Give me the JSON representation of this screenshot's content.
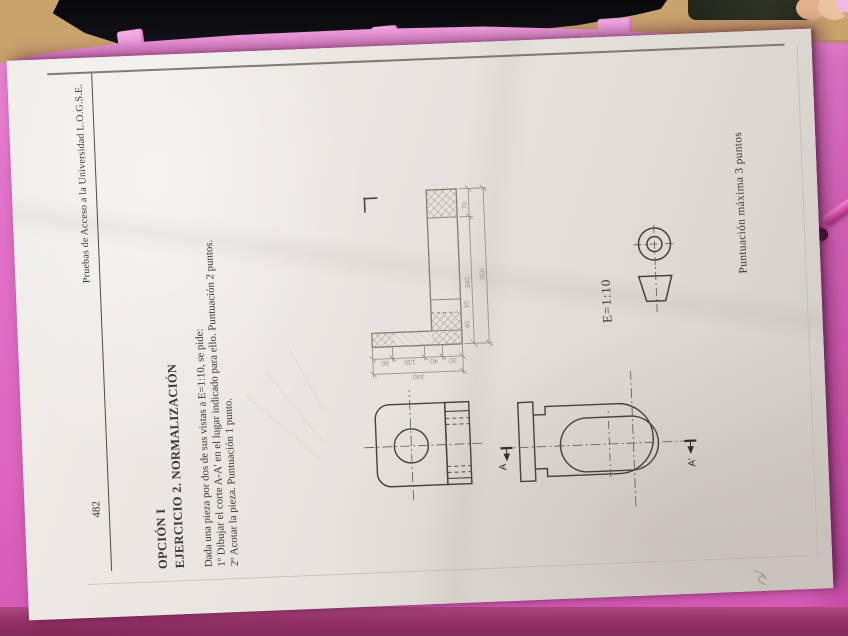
{
  "document": {
    "page_number": "482",
    "header_title": "Pruebas de Acceso a la Universidad  L.O.G.S.E.",
    "option_title": "OPCIÓN I",
    "exercise_title": "EJERCICIO 2.  NORMALIZACIÓN",
    "task_lines": [
      "Dada una pieza por dos de sus vistas a E=1:10, se pide:",
      "1º Dibujar el corte A-A' en el lugar indicado para ello. Puntuación 2 puntos.",
      "2º Acotar la pieza. Puntuación 1 punto."
    ],
    "scale_label": "E=1:10",
    "section_label_a": "A",
    "section_label_a_prime": "A'",
    "footer_note": "Puntuación máxima 3 puntos"
  },
  "sketch_dimensions": {
    "horizontal_chain": [
      "340",
      "70"
    ],
    "horizontal_overall": "350",
    "vertical_chain": [
      "60",
      "130",
      "40",
      "30"
    ],
    "vertical_overall": "340",
    "extra_small": [
      "40",
      "10"
    ]
  },
  "icons": {
    "projection_symbol": "first-angle-projection-symbol",
    "section_cut": "A-A' cut line"
  },
  "colors": {
    "folder_pink": "#e273c9",
    "folder_band_dark": "#97336a",
    "desk_tan": "#c9a36c",
    "paper": "#e8e4df",
    "ink": "#3a3833",
    "pencil": "#8f897c",
    "elastic_pink": "#cb3f9c"
  }
}
